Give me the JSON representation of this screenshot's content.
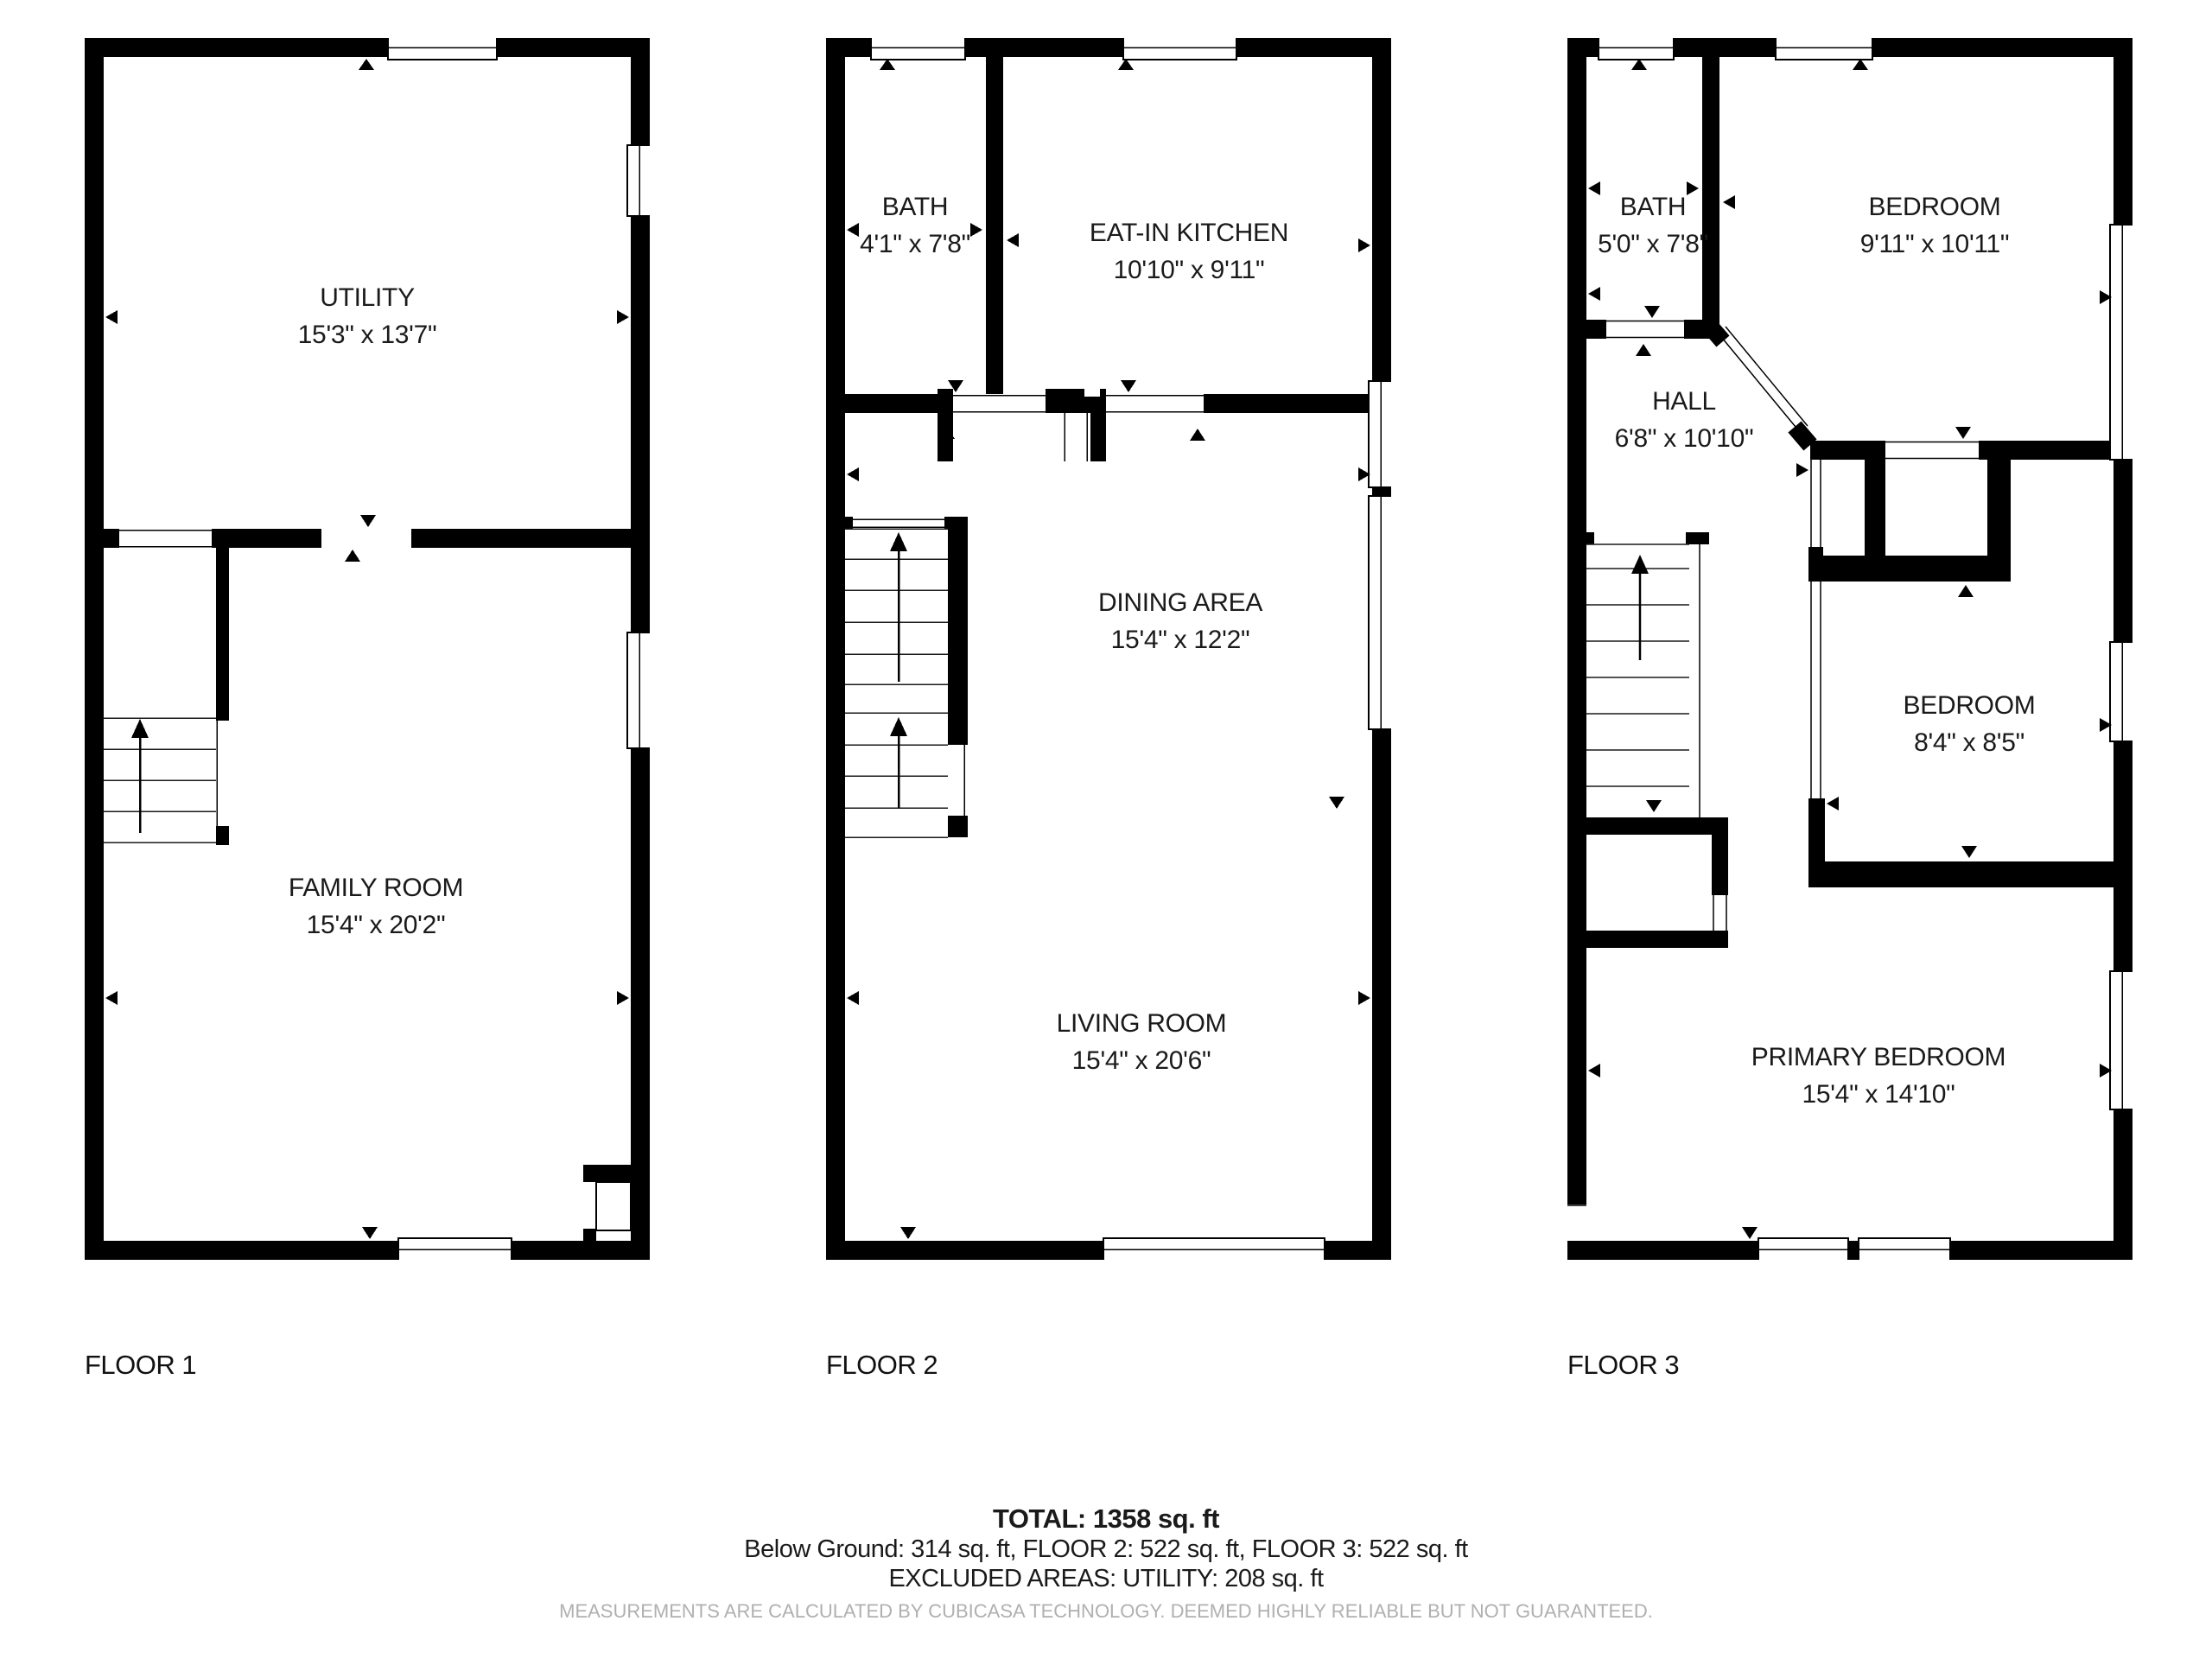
{
  "floors": [
    {
      "label": "FLOOR 1",
      "rooms": [
        {
          "name": "UTILITY",
          "dims": "15'3\" x 13'7\""
        },
        {
          "name": "FAMILY ROOM",
          "dims": "15'4\" x 20'2\""
        }
      ]
    },
    {
      "label": "FLOOR 2",
      "rooms": [
        {
          "name": "BATH",
          "dims": "4'1\" x 7'8\""
        },
        {
          "name": "EAT-IN KITCHEN",
          "dims": "10'10\" x 9'11\""
        },
        {
          "name": "DINING AREA",
          "dims": "15'4\" x 12'2\""
        },
        {
          "name": "LIVING ROOM",
          "dims": "15'4\" x 20'6\""
        }
      ]
    },
    {
      "label": "FLOOR 3",
      "rooms": [
        {
          "name": "BATH",
          "dims": "5'0\" x 7'8\""
        },
        {
          "name": "BEDROOM",
          "dims": "9'11\" x 10'11\""
        },
        {
          "name": "HALL",
          "dims": "6'8\" x 10'10\""
        },
        {
          "name": "BEDROOM",
          "dims": "8'4\" x 8'5\""
        },
        {
          "name": "PRIMARY BEDROOM",
          "dims": "15'4\" x 14'10\""
        }
      ]
    }
  ],
  "summary": {
    "total": "TOTAL: 1358 sq. ft",
    "breakdown": "Below Ground: 314 sq. ft, FLOOR 2: 522 sq. ft, FLOOR 3: 522 sq. ft",
    "excluded": "EXCLUDED AREAS: UTILITY: 208 sq. ft"
  },
  "disclaimer": "MEASUREMENTS ARE CALCULATED BY CUBICASA TECHNOLOGY. DEEMED HIGHLY RELIABLE BUT NOT GUARANTEED.",
  "colors": {
    "wall": "#000000",
    "text": "#1a1a1a",
    "disclaimer": "#b0b0b0"
  }
}
